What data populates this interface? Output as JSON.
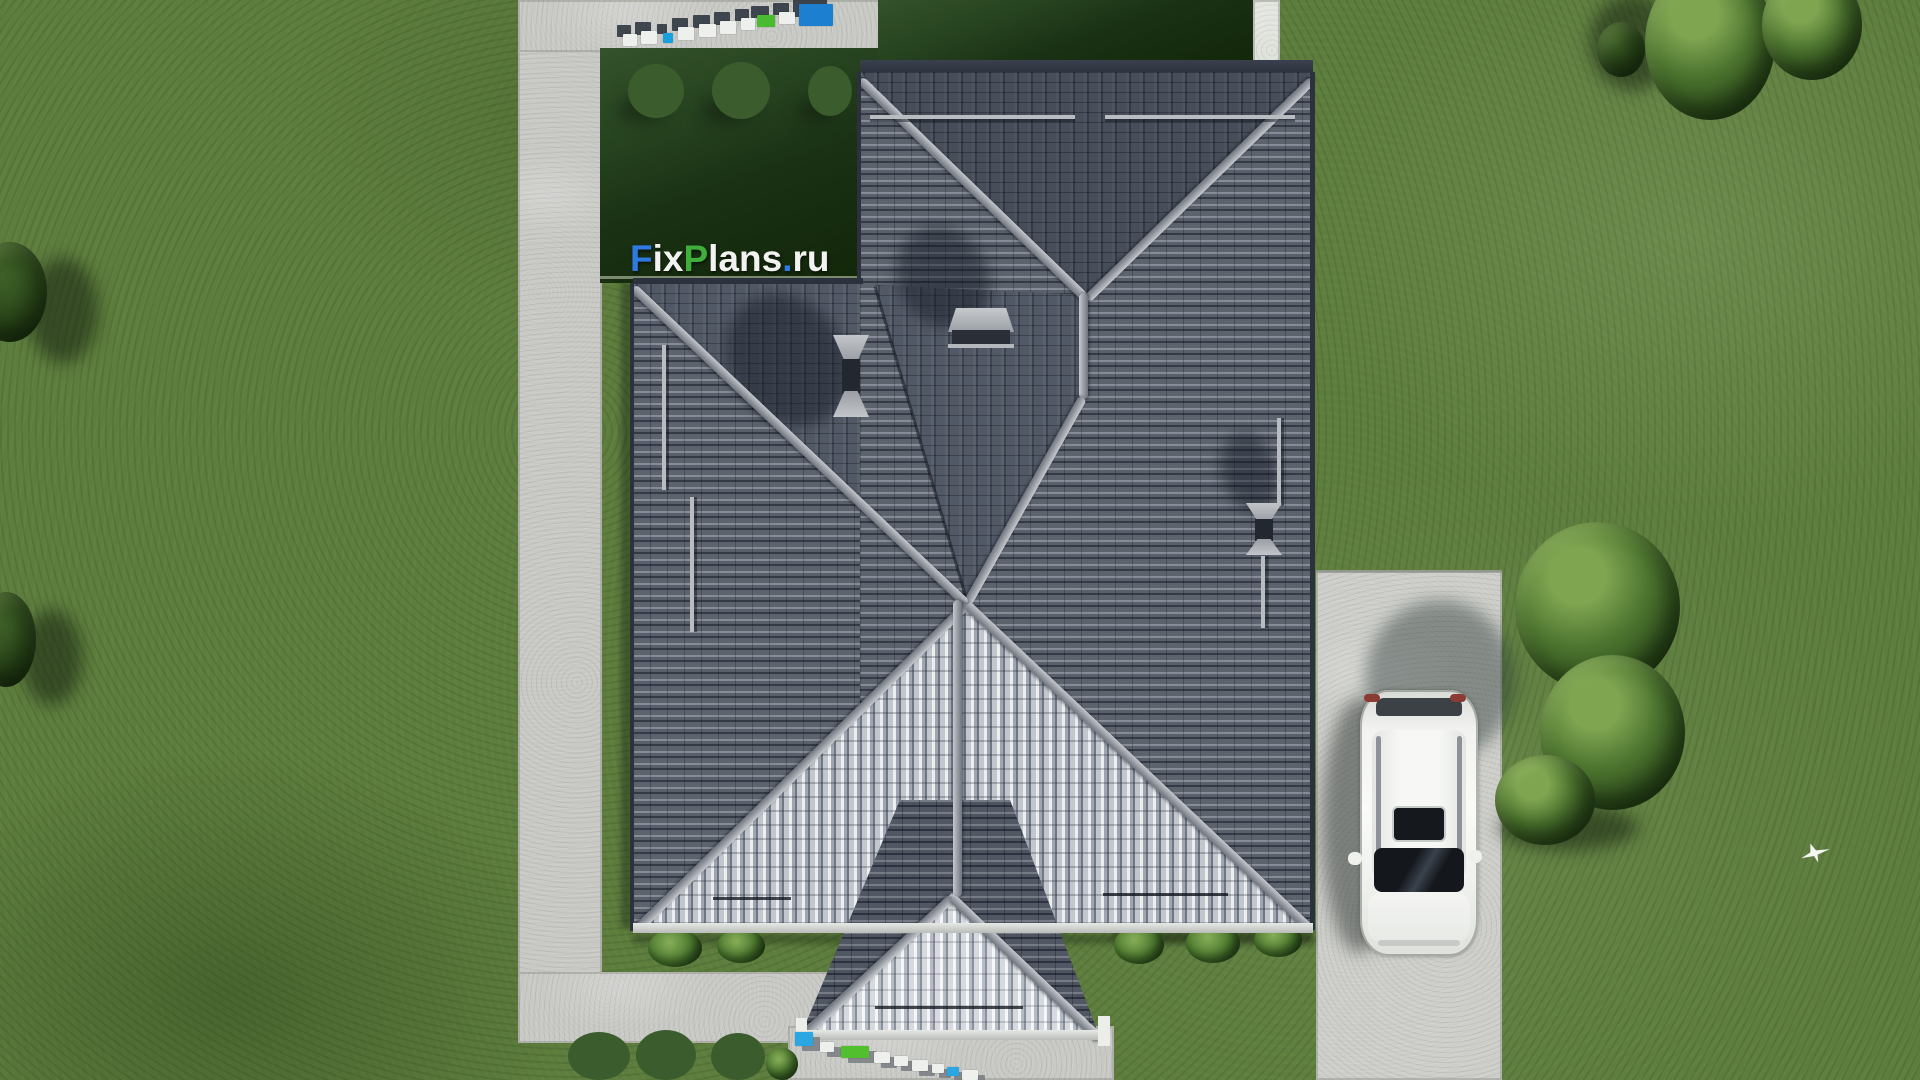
{
  "watermark": {
    "text": "FixPlans.ru",
    "segments": [
      {
        "text": "F",
        "color": "#2f7ae0"
      },
      {
        "text": "ix",
        "color": "#f2f3f1"
      },
      {
        "text": "P",
        "color": "#3fae3b"
      },
      {
        "text": "lans",
        "color": "#f2f3f1"
      },
      {
        "text": ".",
        "color": "#2f7ae0"
      },
      {
        "text": "ru",
        "color": "#f2f3f1"
      }
    ]
  },
  "scene": {
    "description": "Top-down aerial 3D architectural render of a single-family house with a dark gray tiled hip roof, dark back lawn with white flower bushes, concrete garden paths, a concrete driveway with a white SUV, trees and a flying white bird",
    "objects": [
      "hip-roof",
      "roof-windows",
      "snow-guards",
      "chimney-shadows",
      "back-lawn",
      "garden-path",
      "driveway",
      "white-suv",
      "trees",
      "flower-bushes",
      "bird",
      "fixplans-3d-sign"
    ]
  },
  "palette": {
    "grass": "#5d7d3e",
    "dark_lawn": "#1c3316",
    "concrete": "#c9cac6",
    "roof_dark": "#555b66",
    "roof_ridge": "#a6aab0",
    "roof_sunlit": "#d6d9dd",
    "car_body": "#f2f3f1",
    "logo_blue": "#2f7ae0",
    "logo_green": "#3fae3b",
    "logo_white": "#f2f3f1"
  },
  "signs_3d": {
    "top": {
      "shadow": {
        "dx": -6,
        "dy": -9,
        "color": "#262e38"
      },
      "blocks": [
        {
          "x": 623,
          "y": 34,
          "w": 14,
          "h": 12,
          "c": "#eef0ee"
        },
        {
          "x": 641,
          "y": 31,
          "w": 16,
          "h": 13,
          "c": "#eef0ee"
        },
        {
          "x": 663,
          "y": 33,
          "w": 10,
          "h": 10,
          "c": "#18a0dc"
        },
        {
          "x": 678,
          "y": 27,
          "w": 16,
          "h": 13,
          "c": "#eef0ee"
        },
        {
          "x": 699,
          "y": 24,
          "w": 17,
          "h": 13,
          "c": "#eef0ee"
        },
        {
          "x": 720,
          "y": 21,
          "w": 16,
          "h": 13,
          "c": "#eef0ee"
        },
        {
          "x": 741,
          "y": 18,
          "w": 14,
          "h": 12,
          "c": "#eef0ee"
        },
        {
          "x": 757,
          "y": 15,
          "w": 18,
          "h": 12,
          "c": "#49bb30"
        },
        {
          "x": 779,
          "y": 12,
          "w": 16,
          "h": 12,
          "c": "#eef0ee"
        },
        {
          "x": 799,
          "y": 4,
          "w": 34,
          "h": 22,
          "c": "#1d7fd0"
        }
      ]
    },
    "bottom": {
      "shadow": {
        "dx": 7,
        "dy": 5,
        "color": "#787d81"
      },
      "blocks": [
        {
          "x": 795,
          "y": 1032,
          "w": 18,
          "h": 14,
          "c": "#2aa6e2"
        },
        {
          "x": 820,
          "y": 1042,
          "w": 14,
          "h": 10,
          "c": "#eef0ee"
        },
        {
          "x": 841,
          "y": 1046,
          "w": 28,
          "h": 12,
          "c": "#52c02e"
        },
        {
          "x": 874,
          "y": 1052,
          "w": 16,
          "h": 11,
          "c": "#eef0ee"
        },
        {
          "x": 894,
          "y": 1056,
          "w": 14,
          "h": 10,
          "c": "#eef0ee"
        },
        {
          "x": 912,
          "y": 1060,
          "w": 16,
          "h": 11,
          "c": "#eef0ee"
        },
        {
          "x": 932,
          "y": 1064,
          "w": 12,
          "h": 9,
          "c": "#eef0ee"
        },
        {
          "x": 947,
          "y": 1067,
          "w": 12,
          "h": 9,
          "c": "#2aa6e2"
        },
        {
          "x": 962,
          "y": 1070,
          "w": 16,
          "h": 10,
          "c": "#eef0ee"
        }
      ]
    }
  }
}
